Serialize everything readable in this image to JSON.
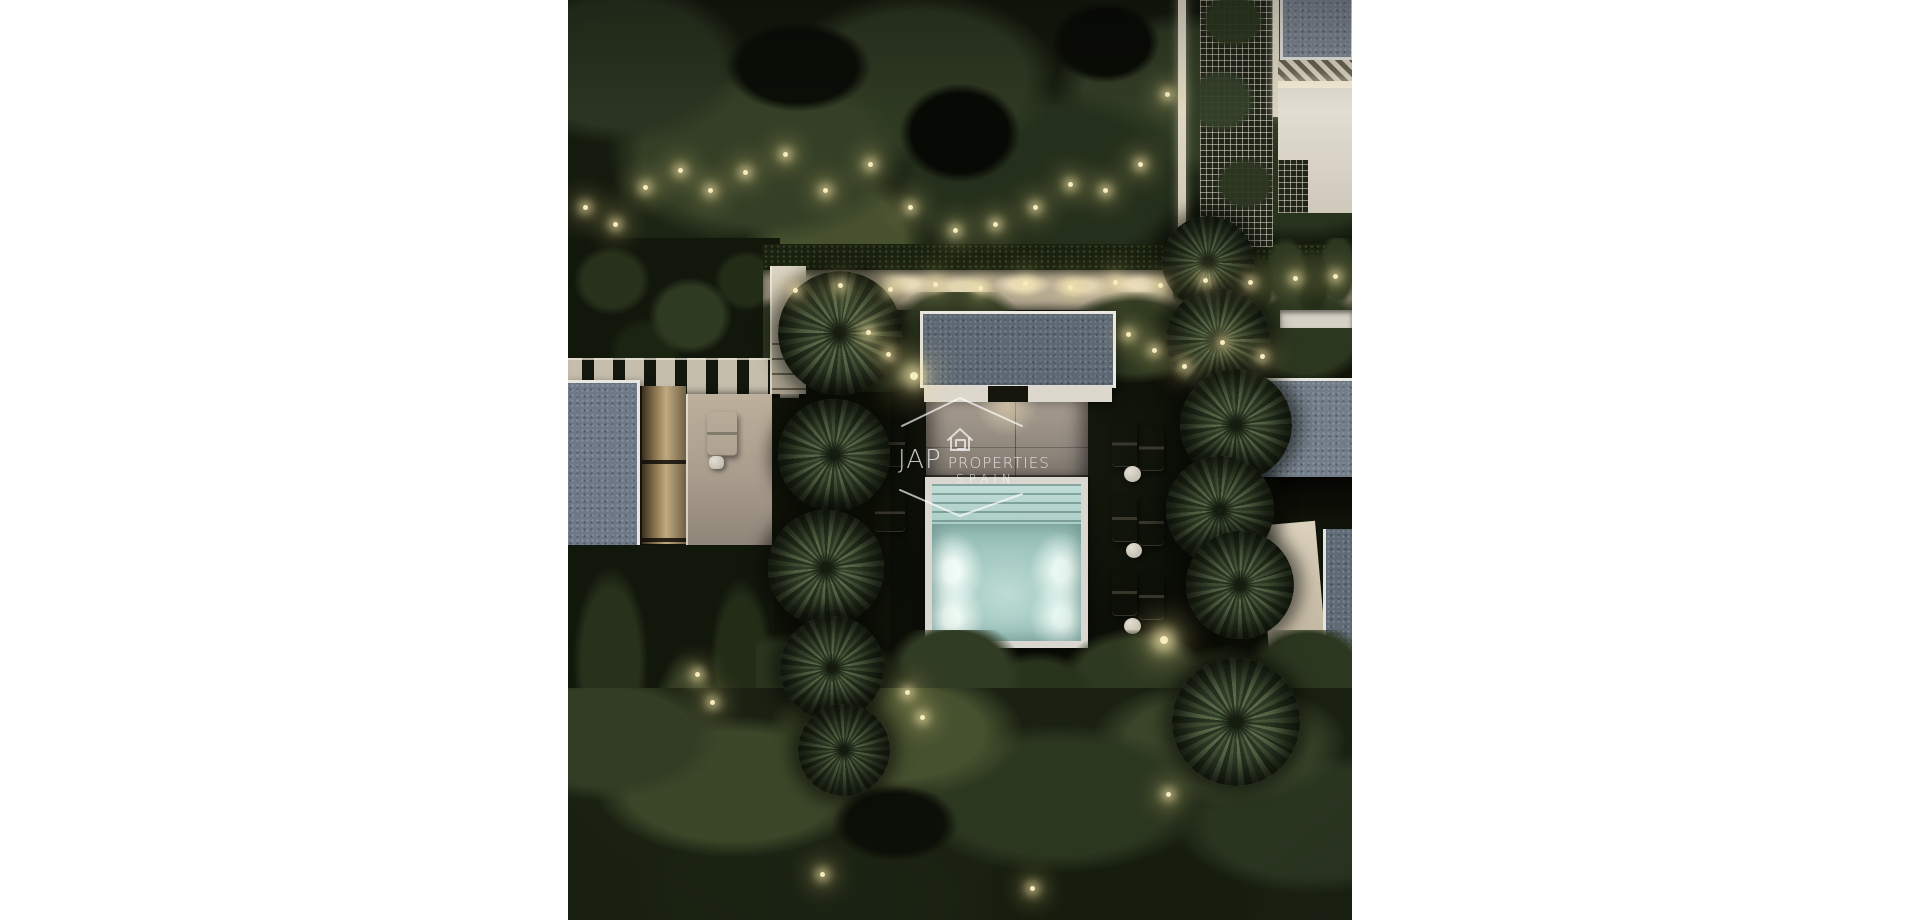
{
  "watermark": {
    "icon": "house-logo-icon",
    "brand": "JAP",
    "brand_word": "PROPERTIES",
    "region": "SPAIN",
    "color": "#ffffff"
  },
  "scene": {
    "alt": "Aerial night 3D render of a modern villa courtyard: illuminated turquoise pool flanked by rows of palm trees and white sun loungers, flat gray roofs, lit garden path and dense dark gardens with warm accent lights",
    "palette": {
      "page_background": "#ffffff",
      "forest_dark": "#141a0e",
      "forest_olive": "#3d4829",
      "accent_light_warm": "#f3e6b4",
      "path_beige": "#bfb49c",
      "roof_gray_blue": "#67727e",
      "roof_frame_white": "#e9e7e1",
      "patio_taupe": "#9a9289",
      "pool_water_aqua": "#9dc4bd",
      "pool_glow": "#effbf5",
      "lounger_white": "#dcd6ca",
      "palm_green": "#4a5a3c"
    }
  }
}
